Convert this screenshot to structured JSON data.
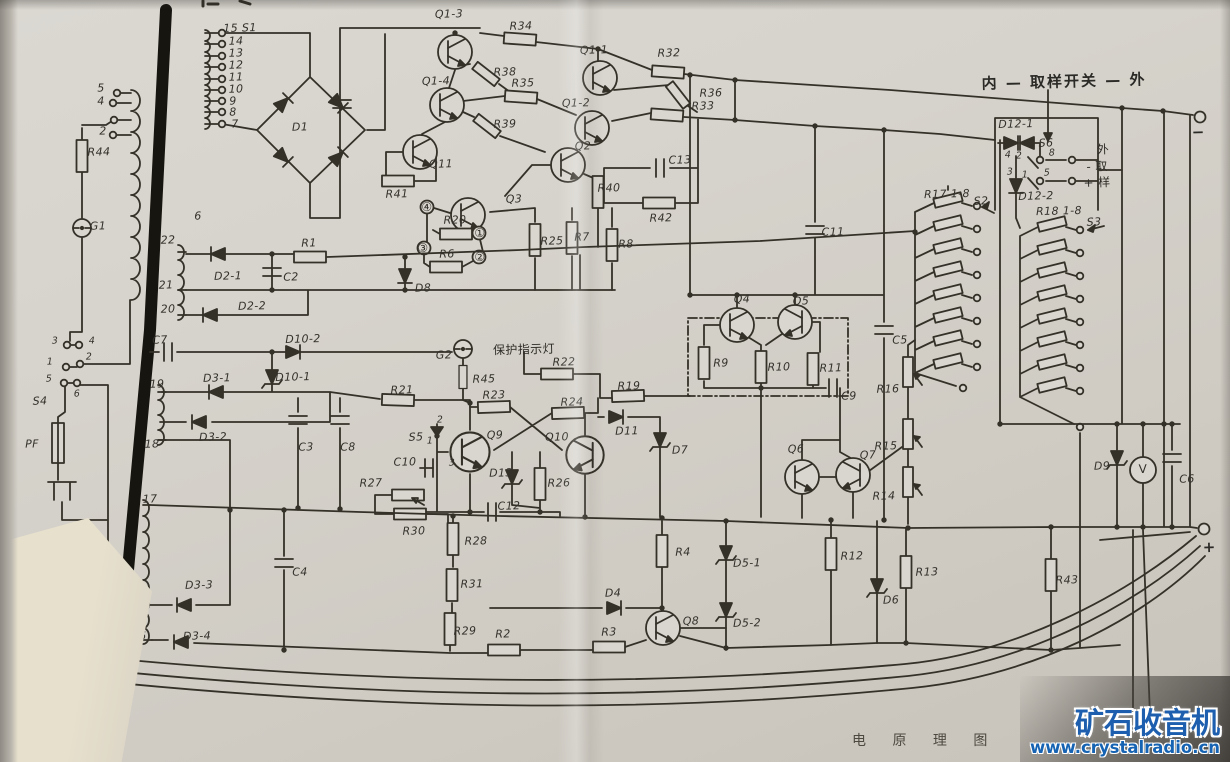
{
  "page": {
    "caption": "电 原 理 图",
    "watermark": {
      "brand": "矿石收音机",
      "url": "www.crystalradio.cn"
    }
  },
  "schematic": {
    "labels": [
      {
        "n": "t15",
        "t": "15 S1",
        "x": 240,
        "y": 28
      },
      {
        "n": "t14",
        "t": "14",
        "x": 236,
        "y": 41
      },
      {
        "n": "t13",
        "t": "13",
        "x": 236,
        "y": 53
      },
      {
        "n": "t12",
        "t": "12",
        "x": 236,
        "y": 65
      },
      {
        "n": "t11",
        "t": "11",
        "x": 236,
        "y": 77
      },
      {
        "n": "t10",
        "t": "10",
        "x": 236,
        "y": 89
      },
      {
        "n": "t9",
        "t": "9",
        "x": 233,
        "y": 101
      },
      {
        "n": "t8",
        "t": "8",
        "x": 233,
        "y": 112
      },
      {
        "n": "t7",
        "t": "7",
        "x": 235,
        "y": 124
      },
      {
        "n": "t6",
        "t": "6",
        "x": 198,
        "y": 216
      },
      {
        "n": "tp5",
        "t": "5",
        "x": 101,
        "y": 88
      },
      {
        "n": "tp4",
        "t": "4",
        "x": 101,
        "y": 101
      },
      {
        "n": "tp2",
        "t": "2",
        "x": 103,
        "y": 131
      },
      {
        "n": "r44",
        "t": "R44",
        "x": 99,
        "y": 152
      },
      {
        "n": "g1",
        "t": "G1",
        "x": 98,
        "y": 226
      },
      {
        "n": "s4c3",
        "t": "3",
        "c": "sm",
        "x": 55,
        "y": 341
      },
      {
        "n": "s4c4",
        "t": "4",
        "c": "sm",
        "x": 92,
        "y": 341
      },
      {
        "n": "s4c2",
        "t": "2",
        "c": "sm",
        "x": 89,
        "y": 357
      },
      {
        "n": "s4c1",
        "t": "1",
        "c": "sm",
        "x": 50,
        "y": 362
      },
      {
        "n": "s4c5",
        "t": "5",
        "c": "sm",
        "x": 49,
        "y": 379
      },
      {
        "n": "s4c6",
        "t": "6",
        "c": "sm",
        "x": 77,
        "y": 394
      },
      {
        "n": "s4",
        "t": "S4",
        "x": 40,
        "y": 401
      },
      {
        "n": "pf",
        "t": "PF",
        "x": 32,
        "y": 444
      },
      {
        "n": "d1",
        "t": "D1",
        "x": 300,
        "y": 127
      },
      {
        "n": "t22",
        "t": "22",
        "x": 168,
        "y": 240
      },
      {
        "n": "d2-1",
        "t": "D2-1",
        "x": 228,
        "y": 276
      },
      {
        "n": "c2",
        "t": "C2",
        "x": 291,
        "y": 277
      },
      {
        "n": "t21",
        "t": "21",
        "x": 166,
        "y": 285
      },
      {
        "n": "t20",
        "t": "20",
        "x": 168,
        "y": 309
      },
      {
        "n": "d2-2",
        "t": "D2-2",
        "x": 252,
        "y": 306
      },
      {
        "n": "r1",
        "t": "R1",
        "x": 309,
        "y": 243
      },
      {
        "n": "r6",
        "t": "R6",
        "x": 447,
        "y": 254
      },
      {
        "n": "d8",
        "t": "D8",
        "x": 423,
        "y": 288
      },
      {
        "n": "q1-3",
        "t": "Q1-3",
        "x": 449,
        "y": 14
      },
      {
        "n": "r34",
        "t": "R34",
        "x": 521,
        "y": 26
      },
      {
        "n": "r38",
        "t": "R38",
        "x": 505,
        "y": 72
      },
      {
        "n": "q1-4",
        "t": "Q1-4",
        "x": 436,
        "y": 81
      },
      {
        "n": "r35",
        "t": "R35",
        "x": 523,
        "y": 83
      },
      {
        "n": "r39",
        "t": "R39",
        "x": 505,
        "y": 124
      },
      {
        "n": "q1-1",
        "t": "Q1-1",
        "x": 594,
        "y": 50
      },
      {
        "n": "r32",
        "t": "R32",
        "x": 669,
        "y": 53
      },
      {
        "n": "r36",
        "t": "R36",
        "x": 711,
        "y": 93
      },
      {
        "n": "q1-2",
        "t": "Q1-2",
        "x": 576,
        "y": 103
      },
      {
        "n": "r33",
        "t": "R33",
        "x": 703,
        "y": 106
      },
      {
        "n": "q2",
        "t": "Q2",
        "x": 583,
        "y": 146
      },
      {
        "n": "r40",
        "t": "R40",
        "x": 609,
        "y": 188
      },
      {
        "n": "c13",
        "t": "C13",
        "x": 680,
        "y": 160
      },
      {
        "n": "r42",
        "t": "R42",
        "x": 661,
        "y": 218
      },
      {
        "n": "r41",
        "t": "R41",
        "x": 397,
        "y": 194
      },
      {
        "n": "q11",
        "t": "Q11",
        "x": 441,
        "y": 164
      },
      {
        "n": "q3",
        "t": "Q3",
        "x": 514,
        "y": 199
      },
      {
        "n": "r20",
        "t": "R20",
        "x": 455,
        "y": 220
      },
      {
        "n": "term4",
        "t": "④",
        "c": "circ",
        "x": 427,
        "y": 207
      },
      {
        "n": "term3",
        "t": "③",
        "c": "circ",
        "x": 423,
        "y": 248
      },
      {
        "n": "term1",
        "t": "①",
        "c": "circ",
        "x": 480,
        "y": 233
      },
      {
        "n": "term2",
        "t": "②",
        "c": "circ",
        "x": 480,
        "y": 257
      },
      {
        "n": "r25",
        "t": "R25",
        "x": 552,
        "y": 241
      },
      {
        "n": "r7",
        "t": "R7",
        "x": 582,
        "y": 237
      },
      {
        "n": "r8",
        "t": "R8",
        "x": 626,
        "y": 244
      },
      {
        "n": "c7",
        "t": "C7",
        "x": 160,
        "y": 340
      },
      {
        "n": "d10-2",
        "t": "D10-2",
        "x": 303,
        "y": 339
      },
      {
        "n": "d10-1",
        "t": "D10-1",
        "x": 293,
        "y": 377
      },
      {
        "n": "t19",
        "t": "19",
        "x": 157,
        "y": 384
      },
      {
        "n": "d3-1",
        "t": "D3-1",
        "x": 217,
        "y": 378
      },
      {
        "n": "d3-2",
        "t": "D3-2",
        "x": 213,
        "y": 437
      },
      {
        "n": "c3",
        "t": "C3",
        "x": 306,
        "y": 447
      },
      {
        "n": "c8",
        "t": "C8",
        "x": 348,
        "y": 447
      },
      {
        "n": "r21",
        "t": "R21",
        "x": 402,
        "y": 390
      },
      {
        "n": "g2",
        "t": "G2",
        "x": 444,
        "y": 355
      },
      {
        "n": "lampnote",
        "t": "保护指示灯",
        "c": "zh",
        "x": 524,
        "y": 349
      },
      {
        "n": "r45",
        "t": "R45",
        "x": 484,
        "y": 379
      },
      {
        "n": "r22",
        "t": "R22",
        "x": 564,
        "y": 362
      },
      {
        "n": "r23",
        "t": "R23",
        "x": 494,
        "y": 395
      },
      {
        "n": "r24",
        "t": "R24",
        "x": 572,
        "y": 402
      },
      {
        "n": "r19",
        "t": "R19",
        "x": 629,
        "y": 386
      },
      {
        "n": "d11",
        "t": "D11",
        "x": 627,
        "y": 431
      },
      {
        "n": "s5c2",
        "t": "2",
        "c": "sm",
        "x": 440,
        "y": 420
      },
      {
        "n": "s5",
        "t": "S5",
        "x": 416,
        "y": 437
      },
      {
        "n": "s5c1",
        "t": "1",
        "c": "sm",
        "x": 430,
        "y": 441
      },
      {
        "n": "s5c3",
        "t": "3",
        "c": "sm",
        "x": 452,
        "y": 463
      },
      {
        "n": "c10",
        "t": "C10",
        "x": 405,
        "y": 462
      },
      {
        "n": "q9",
        "t": "Q9",
        "x": 495,
        "y": 435
      },
      {
        "n": "q10",
        "t": "Q10",
        "x": 557,
        "y": 437
      },
      {
        "n": "d13",
        "t": "D13",
        "x": 501,
        "y": 473
      },
      {
        "n": "r26",
        "t": "R26",
        "x": 559,
        "y": 483
      },
      {
        "n": "c12",
        "t": "C12",
        "x": 509,
        "y": 506
      },
      {
        "n": "r27",
        "t": "R27",
        "x": 371,
        "y": 483
      },
      {
        "n": "r30",
        "t": "R30",
        "x": 414,
        "y": 531
      },
      {
        "n": "r28",
        "t": "R28",
        "x": 476,
        "y": 541
      },
      {
        "n": "r31",
        "t": "R31",
        "x": 472,
        "y": 584
      },
      {
        "n": "r29",
        "t": "R29",
        "x": 465,
        "y": 631
      },
      {
        "n": "r2",
        "t": "R2",
        "x": 503,
        "y": 634
      },
      {
        "n": "r3",
        "t": "R3",
        "x": 609,
        "y": 632
      },
      {
        "n": "d4",
        "t": "D4",
        "x": 613,
        "y": 593
      },
      {
        "n": "q8",
        "t": "Q8",
        "x": 691,
        "y": 621
      },
      {
        "n": "r4",
        "t": "R4",
        "x": 683,
        "y": 552
      },
      {
        "n": "d7",
        "t": "D7",
        "x": 680,
        "y": 450
      },
      {
        "n": "t17",
        "t": "17",
        "x": 150,
        "y": 499
      },
      {
        "n": "t18",
        "t": "18",
        "x": 152,
        "y": 444
      },
      {
        "n": "t16",
        "t": "16",
        "x": 139,
        "y": 636
      },
      {
        "n": "d3-3",
        "t": "D3-3",
        "x": 199,
        "y": 585
      },
      {
        "n": "d3-4",
        "t": "D3-4",
        "x": 197,
        "y": 636
      },
      {
        "n": "c4",
        "t": "C4",
        "x": 300,
        "y": 572
      },
      {
        "n": "q4",
        "t": "Q4",
        "x": 742,
        "y": 299
      },
      {
        "n": "q5",
        "t": "Q5",
        "x": 801,
        "y": 301
      },
      {
        "n": "r9",
        "t": "R9",
        "x": 721,
        "y": 363
      },
      {
        "n": "r10",
        "t": "R10",
        "x": 779,
        "y": 367
      },
      {
        "n": "r11",
        "t": "R11",
        "x": 831,
        "y": 368
      },
      {
        "n": "c9",
        "t": "C9",
        "x": 849,
        "y": 396
      },
      {
        "n": "c11",
        "t": "C11",
        "x": 833,
        "y": 232
      },
      {
        "n": "c5",
        "t": "C5",
        "x": 900,
        "y": 340
      },
      {
        "n": "q6",
        "t": "Q6",
        "x": 796,
        "y": 449
      },
      {
        "n": "q7",
        "t": "Q7",
        "x": 868,
        "y": 455
      },
      {
        "n": "r16",
        "t": "R16",
        "x": 888,
        "y": 389
      },
      {
        "n": "r15",
        "t": "R15",
        "x": 886,
        "y": 446
      },
      {
        "n": "r14",
        "t": "R14",
        "x": 884,
        "y": 496
      },
      {
        "n": "r12",
        "t": "R12",
        "x": 852,
        "y": 556
      },
      {
        "n": "d6",
        "t": "D6",
        "x": 891,
        "y": 600
      },
      {
        "n": "r13",
        "t": "R13",
        "x": 927,
        "y": 572
      },
      {
        "n": "d5-1",
        "t": "D5-1",
        "x": 747,
        "y": 563
      },
      {
        "n": "d5-2",
        "t": "D5-2",
        "x": 747,
        "y": 623
      },
      {
        "n": "r43",
        "t": "R43",
        "x": 1067,
        "y": 580
      },
      {
        "n": "d9",
        "t": "D9",
        "x": 1102,
        "y": 466
      },
      {
        "n": "v-meter",
        "t": "V",
        "c": "circ",
        "x": 1143,
        "y": 469
      },
      {
        "n": "c6",
        "t": "C6",
        "x": 1187,
        "y": 479
      },
      {
        "n": "plus",
        "t": "+",
        "c": "big",
        "x": 1210,
        "y": 547
      },
      {
        "n": "minus",
        "t": "−",
        "c": "big",
        "x": 1199,
        "y": 132
      },
      {
        "n": "r17",
        "t": "R17 1-8",
        "x": 947,
        "y": 194
      },
      {
        "n": "s2",
        "t": "S2",
        "x": 981,
        "y": 201
      },
      {
        "n": "r18",
        "t": "R18 1-8",
        "x": 1059,
        "y": 211
      },
      {
        "n": "s3",
        "t": "S3",
        "x": 1094,
        "y": 222
      },
      {
        "n": "d12-1",
        "t": "D12-1",
        "x": 1016,
        "y": 124
      },
      {
        "n": "d12-2",
        "t": "D12-2",
        "x": 1036,
        "y": 196
      },
      {
        "n": "s6",
        "t": "S6",
        "x": 1046,
        "y": 143
      },
      {
        "n": "s6c8",
        "t": "8",
        "c": "sm",
        "x": 1052,
        "y": 153
      },
      {
        "n": "s6c5",
        "t": "5",
        "c": "sm",
        "x": 1047,
        "y": 173
      },
      {
        "n": "s6c4",
        "t": "4",
        "c": "sm",
        "x": 1008,
        "y": 155
      },
      {
        "n": "s6c2",
        "t": "2",
        "c": "sm",
        "x": 1019,
        "y": 156
      },
      {
        "n": "s6c3",
        "t": "3",
        "c": "sm",
        "x": 1010,
        "y": 172
      },
      {
        "n": "s6c1",
        "t": "1",
        "c": "sm",
        "x": 1025,
        "y": 175
      },
      {
        "n": "waiq",
        "t": "外",
        "c": "zh",
        "x": 1103,
        "y": 149
      },
      {
        "n": "qu",
        "t": "- 取",
        "c": "zh",
        "x": 1097,
        "y": 166
      },
      {
        "n": "yang",
        "t": "+ 样",
        "c": "zh",
        "x": 1097,
        "y": 182
      },
      {
        "n": "switchnote",
        "t": "内 — 取样开关 — 外",
        "c": "big",
        "x": 1064,
        "y": 81
      }
    ]
  }
}
